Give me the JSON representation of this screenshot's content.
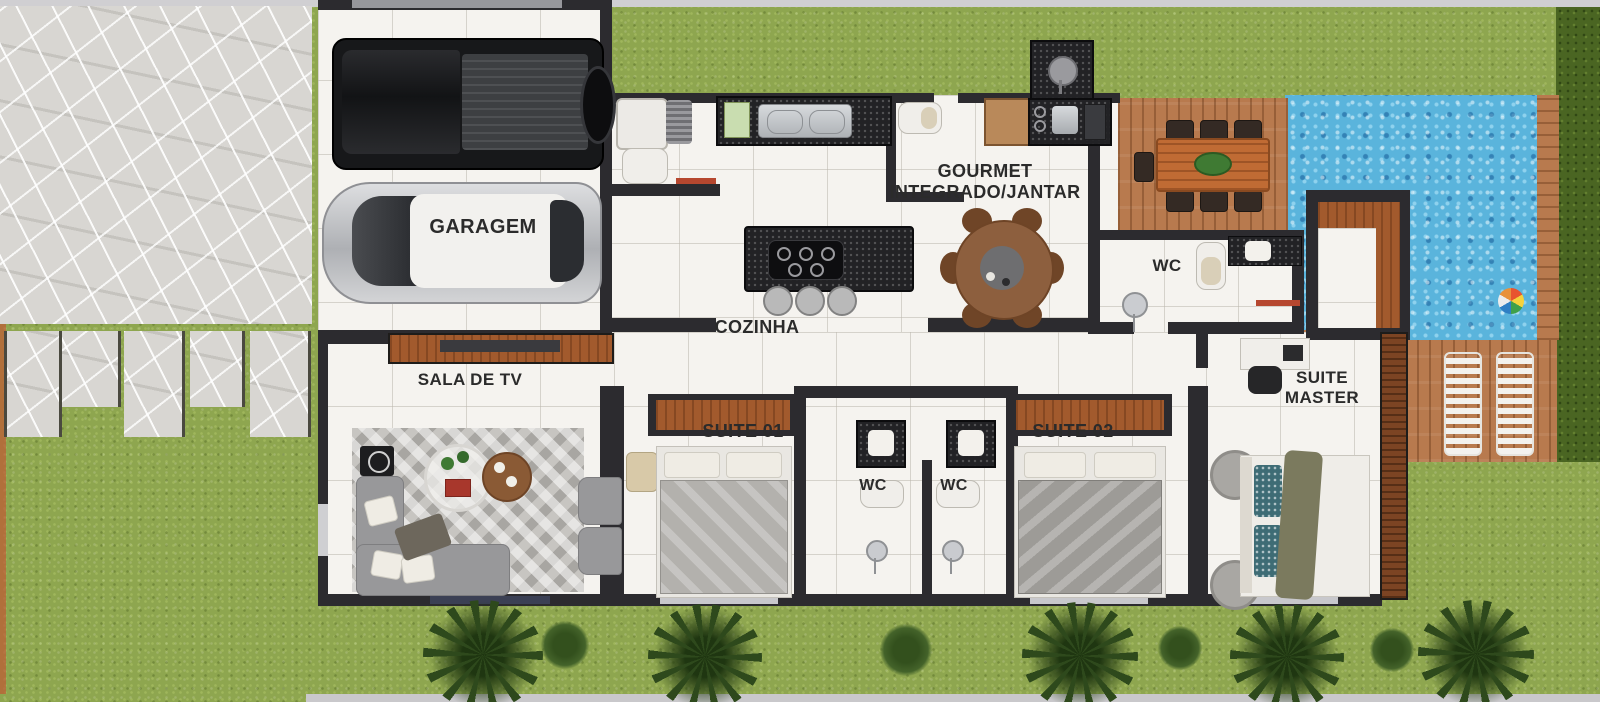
{
  "title": "Planta humanizada de casa térrea com piscina",
  "labels": {
    "garage": "GARAGEM",
    "kitchen": "COZINHA",
    "gourmet_line1": "GOURMET",
    "gourmet_line2": "INTEGRADO/JANTAR",
    "wc_hall": "WC",
    "tv_room": "SALA DE TV",
    "suite1": "SUITE 01",
    "wc_suite1": "WC",
    "wc_suite2": "WC",
    "suite2": "SUITE 02",
    "suite_master_line1": "SUITE",
    "suite_master_line2": "MASTER"
  },
  "colors": {
    "grass": "#8EA64F",
    "hedge": "#4A6522",
    "stone_patio": "#D8D6D2",
    "floor_tile": "#F5F3EF",
    "wall": "#2C2B2F",
    "wood_deck": "#B87A4E",
    "wood_furniture": "#A25A2D",
    "pool_water": "#5AB4DC",
    "counter_granite": "#222225",
    "label_text": "#2B2B2B",
    "towel_red": "#B6472F",
    "pillow_teal": "#3E6C75",
    "sofa_gray": "#98989A"
  }
}
